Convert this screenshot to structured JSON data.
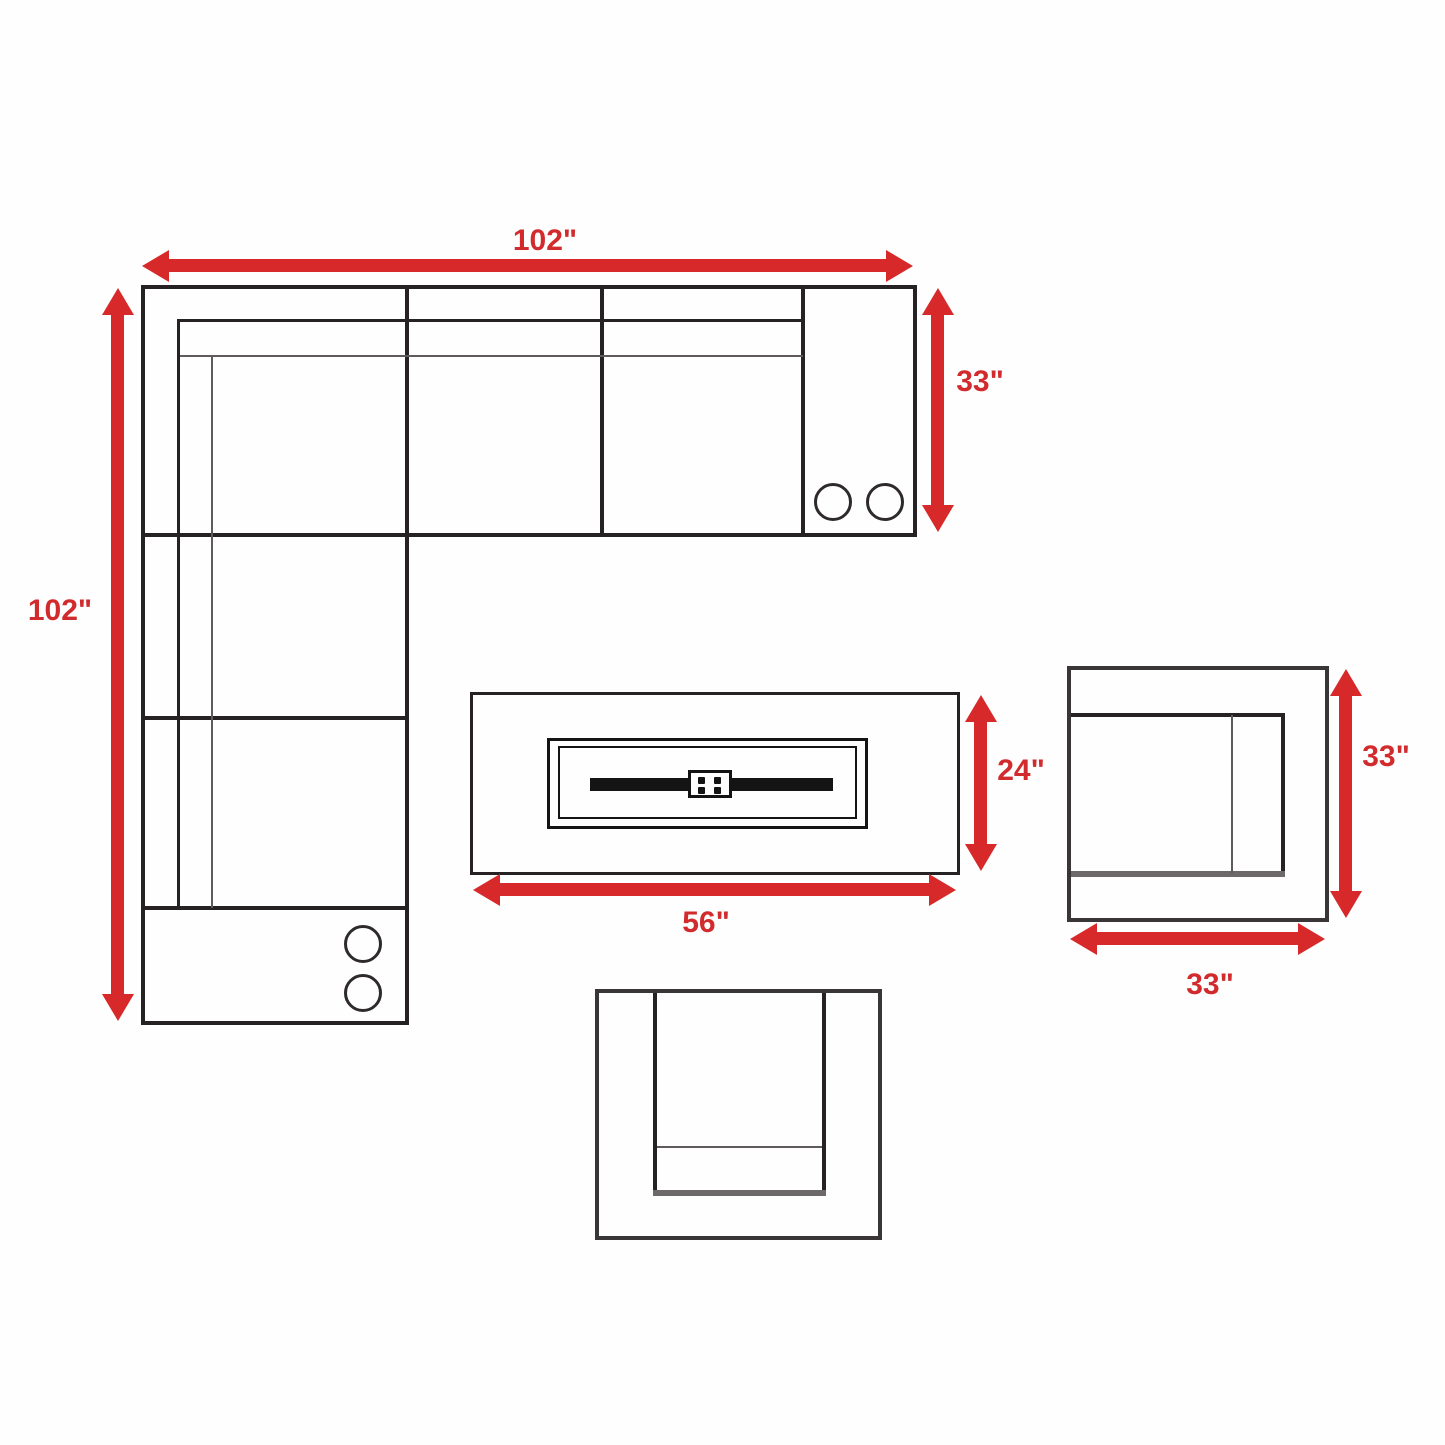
{
  "diagram": {
    "accent_color": "#d7282a",
    "line_color": "#262223",
    "dimensions": {
      "sofa_width": "102\"",
      "sofa_length": "102\"",
      "sofa_depth": "33\"",
      "fire_pit_depth": "24\"",
      "fire_pit_width": "56\"",
      "chair_depth": "33\"",
      "chair_width": "33\""
    }
  }
}
